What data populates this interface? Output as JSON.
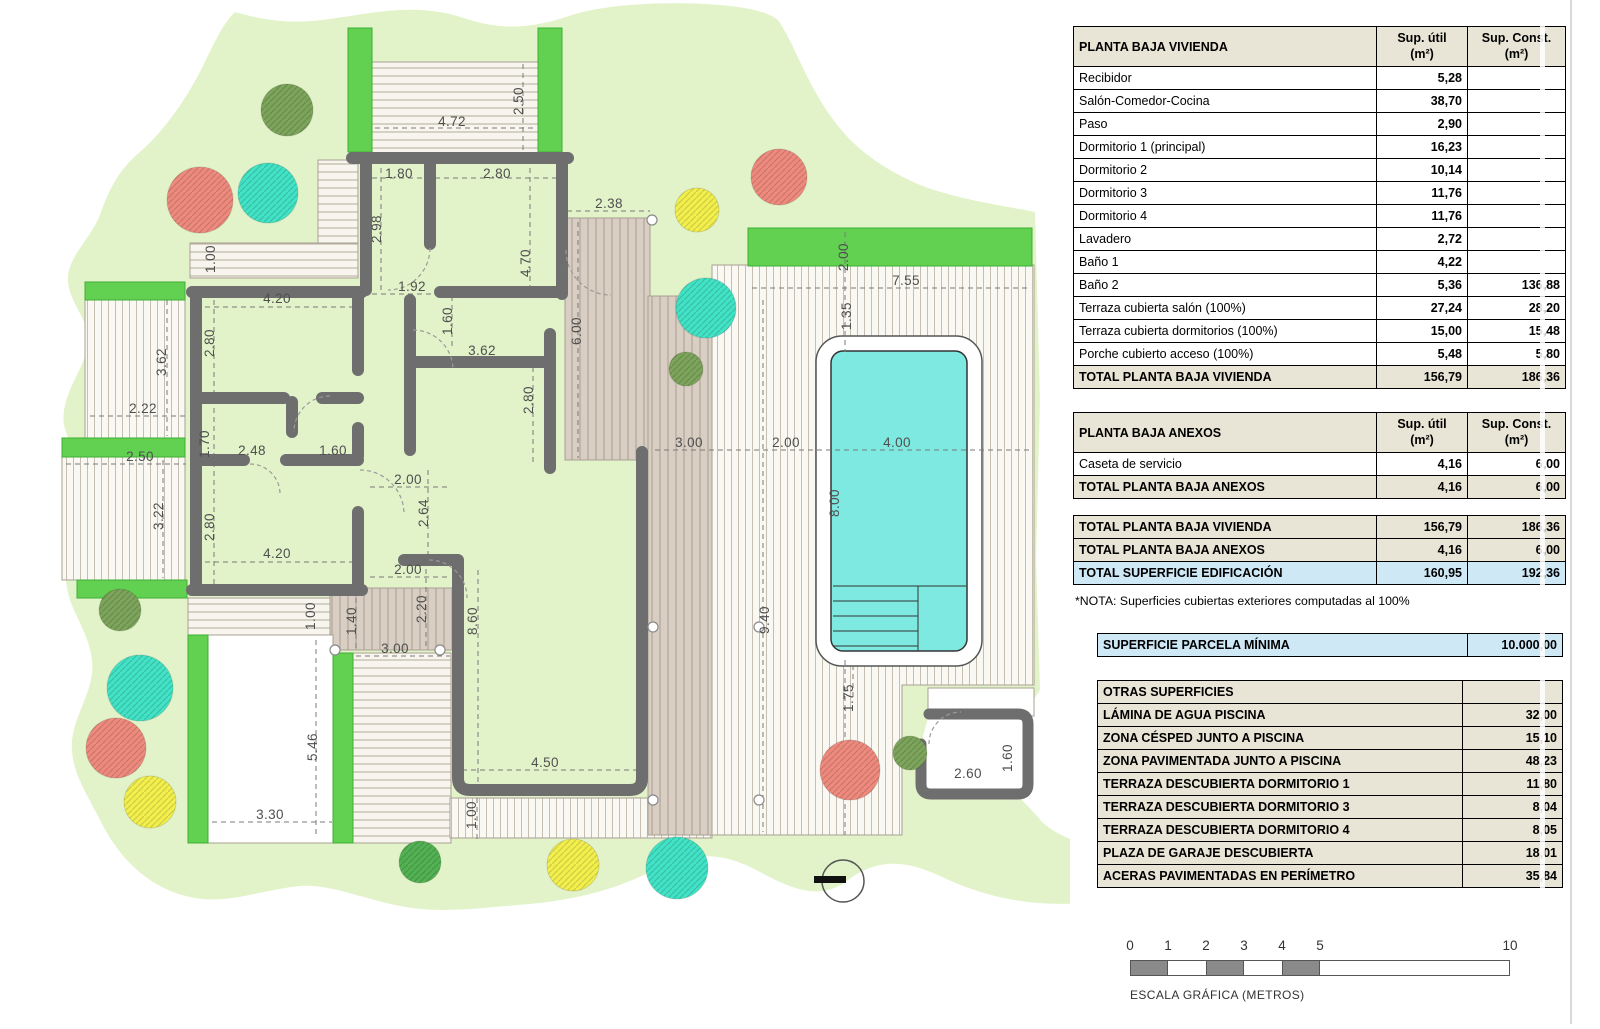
{
  "tables": {
    "vivienda": {
      "title": "PLANTA BAJA VIVIENDA",
      "col1_l1": "Sup. útil",
      "col1_l2": "(m²)",
      "col2_l1": "Sup. Const.",
      "col2_l2": "(m²)",
      "rows": [
        [
          "Recibidor",
          "5,28",
          ""
        ],
        [
          "Salón-Comedor-Cocina",
          "38,70",
          ""
        ],
        [
          "Paso",
          "2,90",
          ""
        ],
        [
          "Dormitorio 1 (principal)",
          "16,23",
          ""
        ],
        [
          "Dormitorio 2",
          "10,14",
          ""
        ],
        [
          "Dormitorio 3",
          "11,76",
          ""
        ],
        [
          "Dormitorio 4",
          "11,76",
          ""
        ],
        [
          "Lavadero",
          "2,72",
          ""
        ],
        [
          "Baño 1",
          "4,22",
          ""
        ],
        [
          "Baño 2",
          "5,36",
          "136,88"
        ],
        [
          "Terraza cubierta salón (100%)",
          "27,24",
          "28,20"
        ],
        [
          "Terraza cubierta dormitorios (100%)",
          "15,00",
          "15,48"
        ],
        [
          "Porche cubierto acceso (100%)",
          "5,48",
          "5,80"
        ]
      ],
      "total": [
        "TOTAL PLANTA BAJA VIVIENDA",
        "156,79",
        "186,36"
      ]
    },
    "anexos": {
      "title": "PLANTA BAJA ANEXOS",
      "col1_l1": "Sup. útil",
      "col1_l2": "(m²)",
      "col2_l1": "Sup. Const.",
      "col2_l2": "(m²)",
      "rows": [
        [
          "Caseta de servicio",
          "4,16",
          "6,00"
        ]
      ],
      "total": [
        "TOTAL PLANTA BAJA ANEXOS",
        "4,16",
        "6,00"
      ]
    },
    "totales": {
      "rows": [
        [
          "TOTAL PLANTA BAJA VIVIENDA",
          "156,79",
          "186,36",
          "beige"
        ],
        [
          "TOTAL PLANTA BAJA ANEXOS",
          "4,16",
          "6,00",
          "beige"
        ],
        [
          "TOTAL SUPERFICIE EDIFICACIÓN",
          "160,95",
          "192,36",
          "blue"
        ]
      ]
    },
    "nota": "*NOTA: Superficies cubiertas exteriores computadas al 100%",
    "parcela": {
      "label": "SUPERFICIE PARCELA MÍNIMA",
      "value": "10.000,00"
    },
    "otras": {
      "title": "OTRAS SUPERFICIES",
      "rows": [
        [
          "LÁMINA DE AGUA PISCINA",
          "32,00"
        ],
        [
          "ZONA CÉSPED JUNTO A PISCINA",
          "15,10"
        ],
        [
          "ZONA PAVIMENTADA JUNTO A PISCINA",
          "48,23"
        ],
        [
          "TERRAZA DESCUBIERTA DORMITORIO 1",
          "11,80"
        ],
        [
          "TERRAZA DESCUBIERTA DORMITORIO 3",
          "8,04"
        ],
        [
          "TERRAZA DESCUBIERTA DORMITORIO 4",
          "8,05"
        ],
        [
          "PLAZA DE GARAJE DESCUBIERTA",
          "18,01"
        ],
        [
          "ACERAS PAVIMENTADAS EN PERÍMETRO",
          "35,84"
        ]
      ]
    }
  },
  "scalebar": {
    "ticks": [
      "0",
      "1",
      "2",
      "3",
      "4",
      "5"
    ],
    "end_tick": "10",
    "caption": "ESCALA GRÁFICA (METROS)",
    "meters_total": 10,
    "dark_segments": [
      [
        0,
        1
      ],
      [
        2,
        3
      ],
      [
        4,
        5
      ]
    ]
  },
  "plan": {
    "colors": {
      "garden": "#e2f3c9",
      "hedge": "#62d152",
      "wall": "#6e6e6e",
      "pool_water": "#7de9e0",
      "tan": "#d9cec3",
      "tree_red": "#ee8a7d",
      "tree_teal": "#41e2c5",
      "tree_olive": "#7ca45b",
      "tree_yellow": "#f2ef4d",
      "tree_green": "#52b152",
      "scale_dark": "#8a8a8a"
    },
    "dims": [
      {
        "t": "2.50",
        "x": 523,
        "y": 101,
        "r": -90
      },
      {
        "t": "4.72",
        "x": 452,
        "y": 126
      },
      {
        "t": "1.80",
        "x": 399,
        "y": 178
      },
      {
        "t": "2.80",
        "x": 497,
        "y": 178
      },
      {
        "t": "2.38",
        "x": 609,
        "y": 208
      },
      {
        "t": "2.98",
        "x": 381,
        "y": 229,
        "r": -90
      },
      {
        "t": "4.70",
        "x": 530,
        "y": 263,
        "r": -90
      },
      {
        "t": "6.00",
        "x": 581,
        "y": 331,
        "r": -90
      },
      {
        "t": "1.92",
        "x": 412,
        "y": 291
      },
      {
        "t": "1.60",
        "x": 452,
        "y": 321,
        "r": -90
      },
      {
        "t": "3.62",
        "x": 482,
        "y": 355
      },
      {
        "t": "2.80",
        "x": 533,
        "y": 400,
        "r": -90
      },
      {
        "t": "1.00",
        "x": 215,
        "y": 259,
        "r": -90
      },
      {
        "t": "4.20",
        "x": 277,
        "y": 303
      },
      {
        "t": "2.80",
        "x": 214,
        "y": 343,
        "r": -90
      },
      {
        "t": "1.70",
        "x": 209,
        "y": 444,
        "r": -90
      },
      {
        "t": "2.48",
        "x": 252,
        "y": 455
      },
      {
        "t": "1.60",
        "x": 333,
        "y": 455
      },
      {
        "t": "2.80",
        "x": 214,
        "y": 527,
        "r": -90
      },
      {
        "t": "4.20",
        "x": 277,
        "y": 558
      },
      {
        "t": "3.62",
        "x": 166,
        "y": 362,
        "r": -90
      },
      {
        "t": "2.22",
        "x": 143,
        "y": 413
      },
      {
        "t": "2.50",
        "x": 140,
        "y": 461
      },
      {
        "t": "3.22",
        "x": 163,
        "y": 516,
        "r": -90
      },
      {
        "t": "2.00",
        "x": 408,
        "y": 484
      },
      {
        "t": "2.64",
        "x": 428,
        "y": 513,
        "r": -90
      },
      {
        "t": "2.00",
        "x": 408,
        "y": 574
      },
      {
        "t": "3.00",
        "x": 689,
        "y": 447
      },
      {
        "t": "2.00",
        "x": 786,
        "y": 447
      },
      {
        "t": "4.00",
        "x": 897,
        "y": 447
      },
      {
        "t": "8.00",
        "x": 839,
        "y": 503,
        "r": -90
      },
      {
        "t": "7.55",
        "x": 906,
        "y": 285
      },
      {
        "t": "2.00",
        "x": 848,
        "y": 257,
        "r": -90
      },
      {
        "t": "1.35",
        "x": 851,
        "y": 316,
        "r": -90
      },
      {
        "t": "9.40",
        "x": 769,
        "y": 620,
        "r": -90
      },
      {
        "t": "1.75",
        "x": 853,
        "y": 698,
        "r": -90
      },
      {
        "t": "1.00",
        "x": 315,
        "y": 616,
        "r": -90
      },
      {
        "t": "1.40",
        "x": 356,
        "y": 621,
        "r": -90
      },
      {
        "t": "2.20",
        "x": 426,
        "y": 609,
        "r": -90
      },
      {
        "t": "8.60",
        "x": 477,
        "y": 621,
        "r": -90
      },
      {
        "t": "3.00",
        "x": 395,
        "y": 653
      },
      {
        "t": "5.46",
        "x": 317,
        "y": 747,
        "r": -90
      },
      {
        "t": "3.30",
        "x": 270,
        "y": 819
      },
      {
        "t": "4.50",
        "x": 545,
        "y": 767
      },
      {
        "t": "1.00",
        "x": 476,
        "y": 815,
        "r": -90
      },
      {
        "t": "2.60",
        "x": 968,
        "y": 778
      },
      {
        "t": "1.60",
        "x": 1012,
        "y": 758,
        "r": -90
      }
    ],
    "trees": [
      {
        "x": 200,
        "y": 200,
        "r": 33,
        "c": "tree_red"
      },
      {
        "x": 268,
        "y": 193,
        "r": 30,
        "c": "tree_teal"
      },
      {
        "x": 287,
        "y": 110,
        "r": 26,
        "c": "tree_olive"
      },
      {
        "x": 697,
        "y": 210,
        "r": 22,
        "c": "tree_yellow"
      },
      {
        "x": 779,
        "y": 177,
        "r": 28,
        "c": "tree_red"
      },
      {
        "x": 706,
        "y": 308,
        "r": 30,
        "c": "tree_teal"
      },
      {
        "x": 686,
        "y": 369,
        "r": 17,
        "c": "tree_olive"
      },
      {
        "x": 120,
        "y": 610,
        "r": 21,
        "c": "tree_olive"
      },
      {
        "x": 140,
        "y": 688,
        "r": 33,
        "c": "tree_teal"
      },
      {
        "x": 116,
        "y": 748,
        "r": 30,
        "c": "tree_red"
      },
      {
        "x": 150,
        "y": 802,
        "r": 26,
        "c": "tree_yellow"
      },
      {
        "x": 420,
        "y": 862,
        "r": 21,
        "c": "tree_green"
      },
      {
        "x": 573,
        "y": 865,
        "r": 26,
        "c": "tree_yellow"
      },
      {
        "x": 677,
        "y": 868,
        "r": 31,
        "c": "tree_teal"
      },
      {
        "x": 850,
        "y": 770,
        "r": 30,
        "c": "tree_red"
      },
      {
        "x": 910,
        "y": 753,
        "r": 17,
        "c": "tree_olive"
      }
    ],
    "posts": [
      {
        "x": 652,
        "y": 220
      },
      {
        "x": 653,
        "y": 627
      },
      {
        "x": 759,
        "y": 627
      },
      {
        "x": 653,
        "y": 800
      },
      {
        "x": 759,
        "y": 800
      },
      {
        "x": 335,
        "y": 650
      },
      {
        "x": 440,
        "y": 650
      }
    ]
  }
}
